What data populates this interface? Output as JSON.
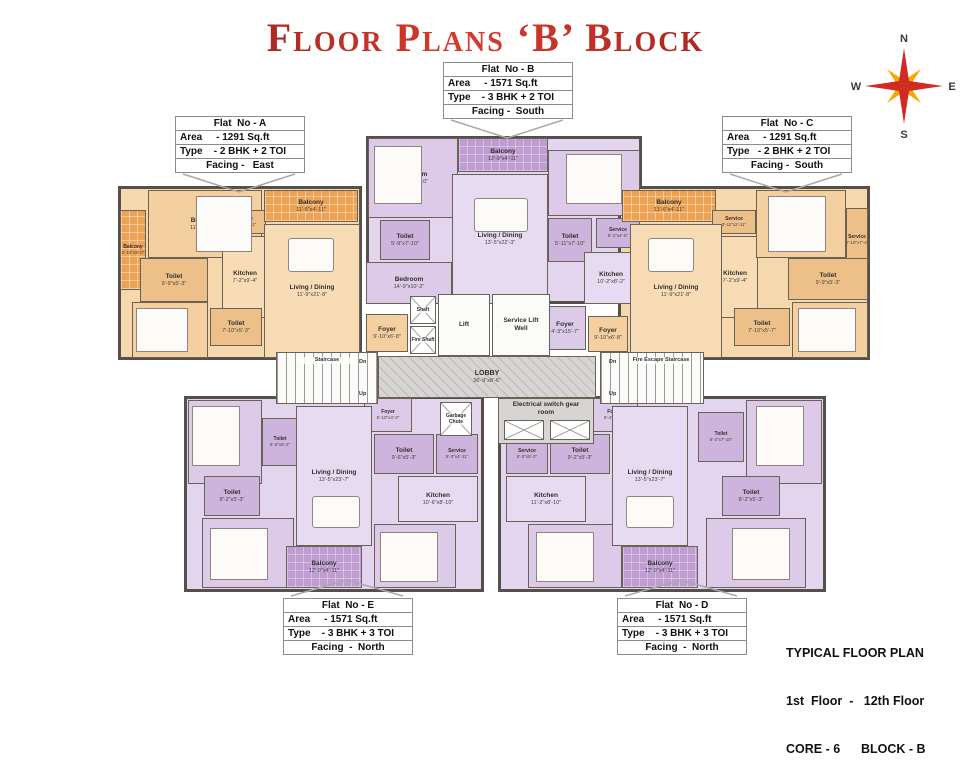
{
  "title": "Floor Plans ‘B’ Block",
  "compass": {
    "north": "N",
    "east": "E",
    "south": "S",
    "west": "W"
  },
  "colors": {
    "title_red": "#9b1b1e",
    "orange_room": "#f4cf9f",
    "orange_balcony": "#eda353",
    "purple_room": "#dccae8",
    "purple_balcony": "#bf9cd2",
    "wall": "#55504b",
    "core_gray": "#d7d5d3",
    "compass_red": "#d22b23",
    "compass_yellow": "#f5a800"
  },
  "flat_boxes": {
    "a": {
      "name": "Flat  No - A",
      "area": "Area     - 1291 Sq.ft",
      "type": "Type    - 2 BHK + 2 TOI",
      "facing": "Facing -   East"
    },
    "b": {
      "name": "Flat  No - B",
      "area": "Area     - 1571 Sq.ft",
      "type": "Type    - 3 BHK + 2 TOI",
      "facing": "Facing -  South"
    },
    "c": {
      "name": "Flat  No - C",
      "area": "Area     - 1291 Sq.ft",
      "type": "Type   - 2 BHK + 2 TOI",
      "facing": "Facing -  South"
    },
    "e": {
      "name": "Flat  No - E",
      "area": "Area     - 1571 Sq.ft",
      "type": "Type    - 3 BHK + 3 TOI",
      "facing": "Facing  -  North"
    },
    "d": {
      "name": "Flat  No - D",
      "area": "Area     - 1571 Sq.ft",
      "type": "Type    - 3 BHK + 3 TOI",
      "facing": "Facing  -  North"
    }
  },
  "core": {
    "lobby_name": "LOBBY",
    "lobby_dims": "36'-9\"x8'-6\"",
    "lift": "Lift",
    "service_lift": "Service Lift Well",
    "shaft": "Shaft",
    "fire_shaft": "Fire Shaft",
    "staircase": "Staircase",
    "fire_escape": "Fire Escape Staircase",
    "dn": "Dn",
    "up": "Up",
    "electrical": "Electrical switch gear room",
    "garbage": "Garbage Chute"
  },
  "flats": {
    "a": {
      "rooms": [
        {
          "name": "Balcony",
          "dims": "2'-10\"x8'-0\""
        },
        {
          "name": "Bedroom",
          "dims": "11'-9\"x11'-9\""
        },
        {
          "name": "Toilet",
          "dims": "9'-9\"x5'-3\""
        },
        {
          "name": "Service",
          "dims": "3'-11\"x2'-11\""
        },
        {
          "name": "Kitchen",
          "dims": "7'-2\"x9'-4\""
        },
        {
          "name": "Bedroom",
          "dims": "9'-9\"x10'-0\""
        },
        {
          "name": "Toilet",
          "dims": "7'-10\"x5'-3\""
        },
        {
          "name": "Balcony",
          "dims": "11'-6\"x4'-11\""
        },
        {
          "name": "Living / Dining",
          "dims": "11'-9\"x21'-8\""
        },
        {
          "name": "Foyer",
          "dims": "9'-10\"x6'-8\""
        }
      ]
    },
    "b": {
      "rooms": [
        {
          "name": "Bedroom",
          "dims": "11'-9\"x9'-10\""
        },
        {
          "name": "Balcony",
          "dims": "12'-9\"x4'-11\""
        },
        {
          "name": "Toilet",
          "dims": "5'-9\"x7'-10\""
        },
        {
          "name": "Living / Dining",
          "dims": "13'-5\"x22'-3\""
        },
        {
          "name": "Bedroom",
          "dims": "14'-9\"x10'-2\""
        },
        {
          "name": "Bedroom",
          "dims": "11'-9\"x11'-9\""
        },
        {
          "name": "Toilet",
          "dims": "5'-11\"x7'-10\""
        },
        {
          "name": "Service",
          "dims": "5'-1\"x4'-5\""
        },
        {
          "name": "Kitchen",
          "dims": "10'-2\"x8'-2\""
        },
        {
          "name": "Foyer",
          "dims": "4'-3\"x15'-7\""
        }
      ]
    },
    "c": {
      "rooms": [
        {
          "name": "Balcony",
          "dims": "11'-6\"x4'-11\""
        },
        {
          "name": "Service",
          "dims": "3'-11\"x2'-11\""
        },
        {
          "name": "Kitchen",
          "dims": "7'-2\"x9'-4\""
        },
        {
          "name": "Bedroom",
          "dims": "11'-9\"x11'-9\""
        },
        {
          "name": "Service",
          "dims": "2'-10\"x7'-4\""
        },
        {
          "name": "Toilet",
          "dims": "9'-9\"x5'-3\""
        },
        {
          "name": "Toilet",
          "dims": "7'-10\"x5'-7\""
        },
        {
          "name": "Bedroom",
          "dims": "10'-1\"x10'-0\""
        },
        {
          "name": "Living / Dining",
          "dims": "11'-9\"x21'-8\""
        },
        {
          "name": "Foyer",
          "dims": "9'-10\"x6'-8\""
        }
      ]
    },
    "e": {
      "rooms": [
        {
          "name": "Foyer",
          "dims": "6'-10\"x4'-3\""
        },
        {
          "name": "Toilet",
          "dims": "9'-6\"x5'-3\""
        },
        {
          "name": "Service",
          "dims": "5'-3\"x4'-11\""
        },
        {
          "name": "Kitchen",
          "dims": "10'-6\"x8'-10\""
        },
        {
          "name": "Bedroom",
          "dims": "11'-9\"x9'-10\""
        },
        {
          "name": "Bedroom",
          "dims": "9'-10\"x11'-6\""
        },
        {
          "name": "Toilet",
          "dims": "5'-3\"x8'-2\""
        },
        {
          "name": "Toilet",
          "dims": "8'-2\"x5'-3\""
        },
        {
          "name": "Bedroom",
          "dims": "11'-9\"x12'-1\""
        },
        {
          "name": "Living / Dining",
          "dims": "13'-5\"x23'-7\""
        },
        {
          "name": "Balcony",
          "dims": "12'-9\"x4'-11\""
        }
      ]
    },
    "d": {
      "rooms": [
        {
          "name": "Foyer",
          "dims": "6'-4\"x4'-3\""
        },
        {
          "name": "Toilet",
          "dims": "9'-2\"x5'-3\""
        },
        {
          "name": "Service",
          "dims": "5'-3\"x5'-3\""
        },
        {
          "name": "Kitchen",
          "dims": "11'-2\"x8'-10\""
        },
        {
          "name": "Bedroom",
          "dims": "11'-9\"x9'-10\""
        },
        {
          "name": "Bedroom",
          "dims": "9'-10\"x11'-6\""
        },
        {
          "name": "Toilet",
          "dims": "5'-3\"x7'-10\""
        },
        {
          "name": "Toilet",
          "dims": "8'-2\"x5'-3\""
        },
        {
          "name": "Bedroom",
          "dims": "11'-9\"x12'-1\""
        },
        {
          "name": "Living / Dining",
          "dims": "13'-5\"x23'-7\""
        },
        {
          "name": "Balcony",
          "dims": "12'-9\"x4'-11\""
        }
      ]
    }
  },
  "footer": {
    "line1": "TYPICAL FLOOR PLAN",
    "line2": "1st  Floor  -   12th Floor",
    "line3": "CORE - 6      BLOCK - B"
  }
}
